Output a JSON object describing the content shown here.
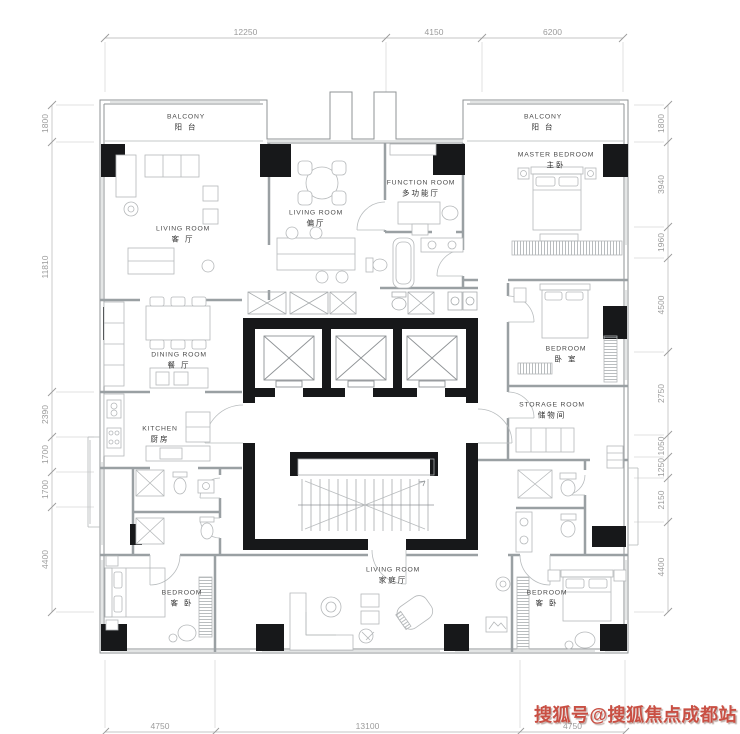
{
  "watermark": {
    "text": "搜狐号@搜狐焦点成都站",
    "color": "#c94f43"
  },
  "rooms": [
    {
      "id": "balcony-left",
      "en": "BALCONY",
      "zh": "阳 台",
      "x": 186,
      "y": 118
    },
    {
      "id": "balcony-right",
      "en": "BALCONY",
      "zh": "阳 台",
      "x": 543,
      "y": 118
    },
    {
      "id": "master-bedroom",
      "en": "MASTER BEDROOM",
      "zh": "主卧",
      "x": 556,
      "y": 156
    },
    {
      "id": "living-room-main",
      "en": "LIVING ROOM",
      "zh": "客 厅",
      "x": 183,
      "y": 230
    },
    {
      "id": "living-room-second",
      "en": "LIVING ROOM",
      "zh": "偏厅",
      "x": 316,
      "y": 214
    },
    {
      "id": "function-room",
      "en": "FUNCTION ROOM",
      "zh": "多功能厅",
      "x": 421,
      "y": 184
    },
    {
      "id": "dining-room",
      "en": "DINING ROOM",
      "zh": "餐 厅",
      "x": 179,
      "y": 356
    },
    {
      "id": "kitchen",
      "en": "KITCHEN",
      "zh": "厨房",
      "x": 160,
      "y": 430
    },
    {
      "id": "bedroom-east",
      "en": "BEDROOM",
      "zh": "卧 室",
      "x": 566,
      "y": 350
    },
    {
      "id": "storage-room",
      "en": "STORAGE ROOM",
      "zh": "储物间",
      "x": 552,
      "y": 406
    },
    {
      "id": "bedroom-southwest",
      "en": "BEDROOM",
      "zh": "客 卧",
      "x": 182,
      "y": 594
    },
    {
      "id": "family-room",
      "en": "LIVING ROOM",
      "zh": "家庭厅",
      "x": 393,
      "y": 571
    },
    {
      "id": "bedroom-southeast",
      "en": "BEDROOM",
      "zh": "客 卧",
      "x": 547,
      "y": 594
    }
  ],
  "dims": {
    "top": {
      "line": 38,
      "segments": [
        {
          "label": "12250",
          "from": 105,
          "to": 386
        },
        {
          "label": "4150",
          "from": 386,
          "to": 482
        },
        {
          "label": "6200",
          "from": 482,
          "to": 623
        }
      ]
    },
    "left": {
      "line": 52,
      "segments": [
        {
          "label": "1800",
          "from": 105,
          "to": 142
        },
        {
          "label": "11810",
          "from": 142,
          "to": 392
        },
        {
          "label": "2390",
          "from": 392,
          "to": 437
        },
        {
          "label": "1700",
          "from": 437,
          "to": 472
        },
        {
          "label": "1700",
          "from": 472,
          "to": 507
        },
        {
          "label": "4400",
          "from": 507,
          "to": 612
        }
      ]
    },
    "right": {
      "line": 668,
      "segments": [
        {
          "label": "1800",
          "from": 105,
          "to": 142
        },
        {
          "label": "3940",
          "from": 142,
          "to": 227
        },
        {
          "label": "1960",
          "from": 227,
          "to": 258
        },
        {
          "label": "4500",
          "from": 258,
          "to": 352
        },
        {
          "label": "2750",
          "from": 352,
          "to": 435
        },
        {
          "label": "1050",
          "from": 435,
          "to": 457
        },
        {
          "label": "1250",
          "from": 457,
          "to": 478
        },
        {
          "label": "2150",
          "from": 478,
          "to": 522
        },
        {
          "label": "4400",
          "from": 522,
          "to": 612
        }
      ]
    },
    "bottom": {
      "line": 732,
      "segments": [
        {
          "label": "4750",
          "from": 105,
          "to": 215
        },
        {
          "label": "13100",
          "from": 215,
          "to": 520
        },
        {
          "label": "4750",
          "from": 520,
          "to": 625
        }
      ]
    }
  }
}
